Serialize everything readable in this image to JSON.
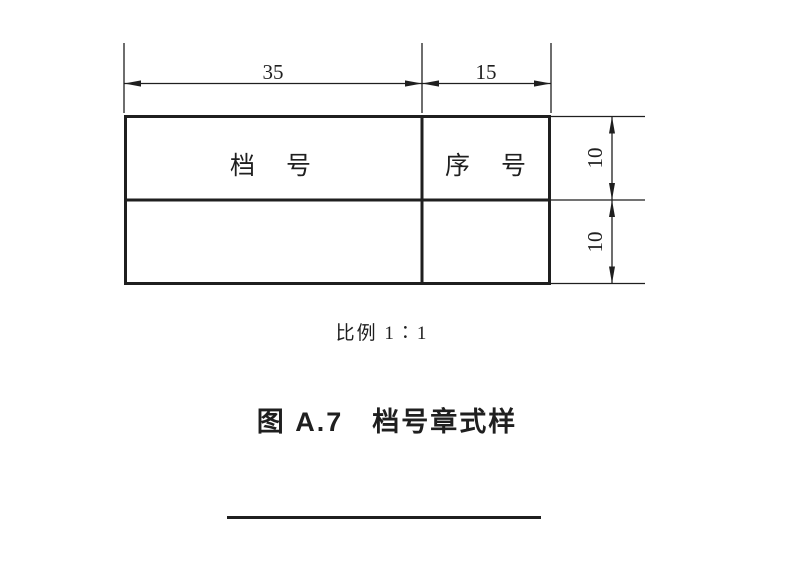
{
  "colors": {
    "line": "#1f1f1f",
    "text": "#1f1f1f",
    "background": "#ffffff"
  },
  "drawing": {
    "stamp_table": {
      "header_cells": [
        {
          "label": "档　号"
        },
        {
          "label": "序　号"
        }
      ]
    },
    "dimensions": {
      "top_width_left": "35",
      "top_width_right": "15",
      "right_height_upper": "10",
      "right_height_lower": "10"
    }
  },
  "captions": {
    "scale_note": "比例 1∶1",
    "figure_title": "图 A.7　档号章式样"
  }
}
